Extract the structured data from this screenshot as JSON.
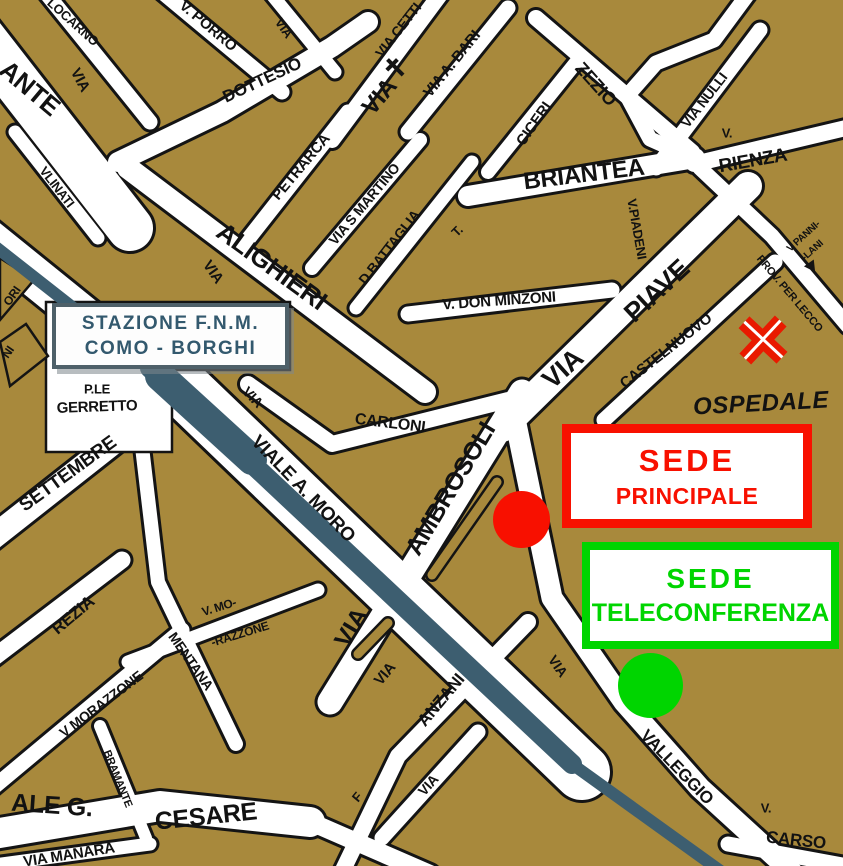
{
  "map_title": "Como city map with company locations",
  "colors": {
    "block": "#A8893C",
    "street": "#FFFFFF",
    "outline": "#141414",
    "railway": "#3D5E70",
    "station_text": "#33596E",
    "red": "#F81000",
    "green": "#00D500"
  },
  "station": {
    "line1": "STAZIONE F.N.M.",
    "line2": "COMO - BORGHI"
  },
  "sede_principale": {
    "title": "SEDE",
    "subtitle": "PRINCIPALE"
  },
  "sede_teleconferenza": {
    "title": "SEDE",
    "subtitle": "TELECONFERENZA"
  },
  "labels": {
    "ante": "ANTE",
    "via": "VIA",
    "locarno": "LOCARNO",
    "porro": "V. PORRO",
    "dottesio": "DOTTESIO",
    "via_cetti": "VIA CETTI",
    "via_a_bari": "VIA A. BARI",
    "ciceri": "CICERI",
    "zezio": "ZEZIO",
    "briantea": "BRIANTEA",
    "via_nulli": "VIA NULLI",
    "v_abbrev": "V.",
    "rienza": "RIENZA",
    "pannilani_1": "V PANNI-",
    "pannilani_2": "-LANI",
    "prov_per_lecco": "PROV. PER LECCO",
    "vlinati": "VLINATI",
    "petrarca": "PETRARCA",
    "via_s_martino": "VIA S MARTINO",
    "d_battaglia": "D.BATTAGLIA",
    "t_abbrev": "T.",
    "alighieri": "ALIGHIERI",
    "don_minzoni": "V. DON MINZONI",
    "piave": "PIAVE",
    "piadeni": "V.PIADENI",
    "castelnuovo": "CASTELNUOVO",
    "ospedale": "OSPEDALE",
    "carloni": "CARLONI",
    "ambrosoli": "AMBROSOLI",
    "viale_a_moro": "VIALE A. MORO",
    "settembre": "SETTEMBRE",
    "ple": "P.LE",
    "gerretto": "GERRETTO",
    "rezia": "REZIA",
    "mentana": "MENTANA",
    "v_mo": "V. MO-",
    "razzone": "-RAZZONE",
    "v_morazzone": "V MORAZZONE",
    "bramante": "BRAMANTE",
    "viale_g": "ALE G.",
    "cesare": "CESARE",
    "via_manara": "VIA MANARA",
    "anzani": "ANZANI",
    "valleggio": "VALLEGGIO",
    "carso": "CARSO",
    "f_partial": "F",
    "ori_partial": "ORI",
    "ni_partial": "NI"
  }
}
